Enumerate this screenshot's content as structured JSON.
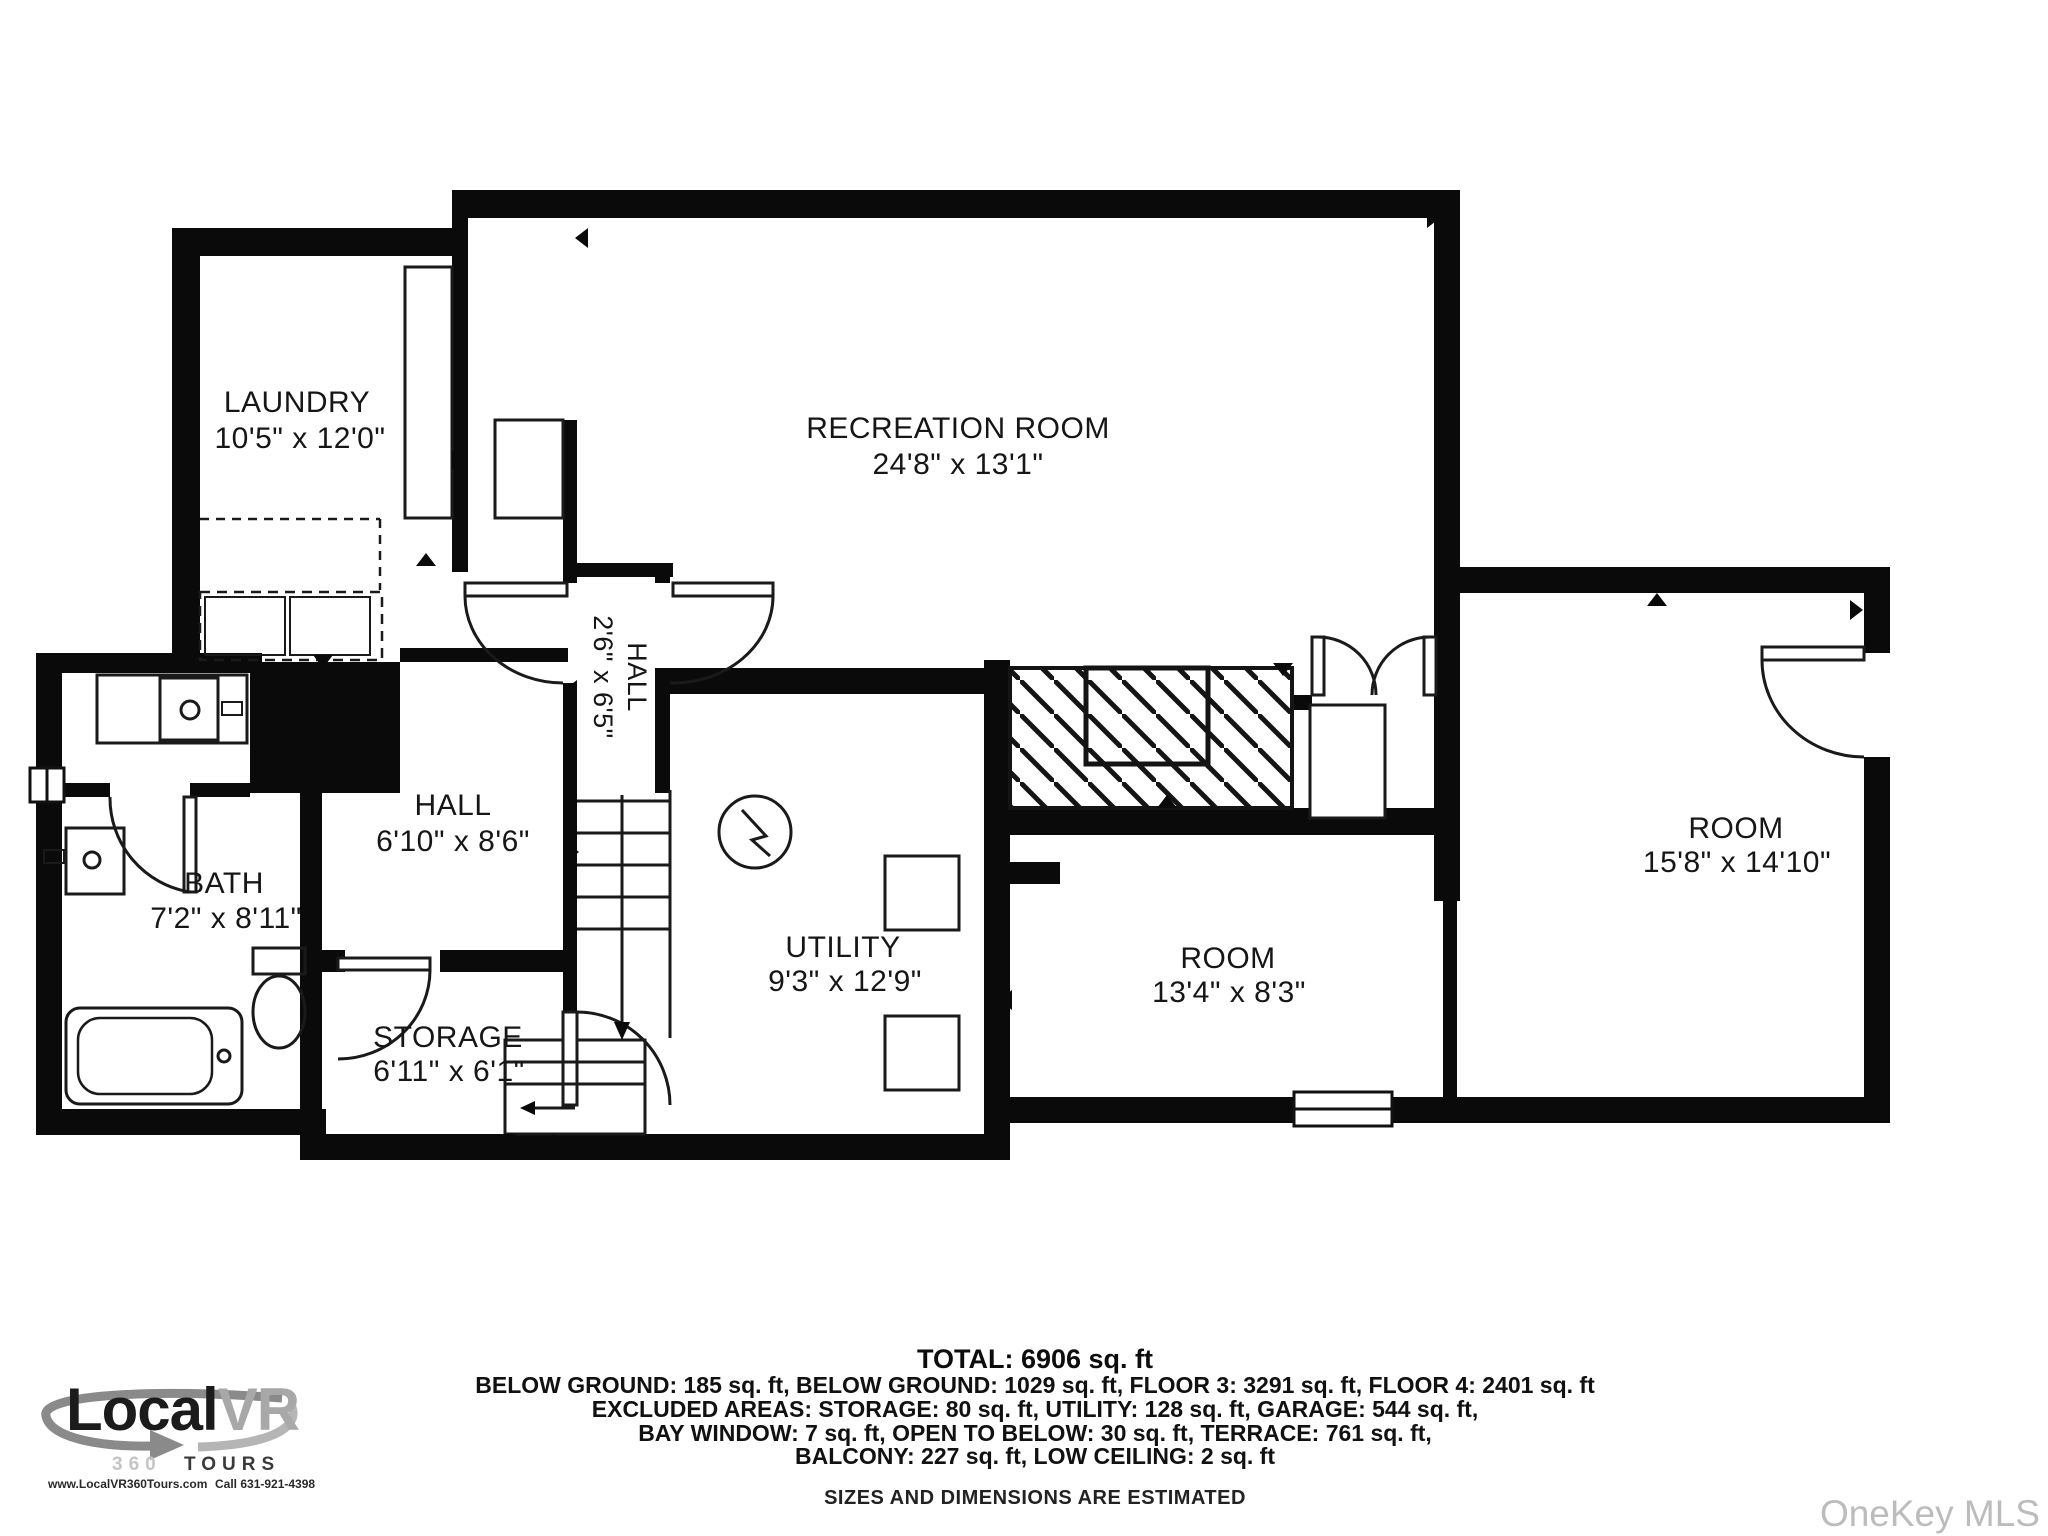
{
  "rooms": [
    {
      "name": "LAUNDRY",
      "dims": "10'5\" x 12'0\""
    },
    {
      "name": "RECREATION ROOM",
      "dims": "24'8\" x 13'1\""
    },
    {
      "name": "HALL",
      "dims": "2'6\" x 6'5\""
    },
    {
      "name": "HALL",
      "dims": "6'10\" x 8'6\""
    },
    {
      "name": "BATH",
      "dims": "7'2\" x 8'11\""
    },
    {
      "name": "STORAGE",
      "dims": "6'11\" x 6'1\""
    },
    {
      "name": "UTILITY",
      "dims": "9'3\" x 12'9\""
    },
    {
      "name": "ROOM",
      "dims": "13'4\" x 8'3\""
    },
    {
      "name": "ROOM",
      "dims": "15'8\" x 14'10\""
    }
  ],
  "footer": {
    "total": "TOTAL: 6906 sq. ft",
    "line1": "BELOW GROUND: 185 sq. ft, BELOW GROUND: 1029 sq. ft, FLOOR 3: 3291 sq. ft, FLOOR 4: 2401 sq. ft",
    "line2": "EXCLUDED AREAS: STORAGE: 80 sq. ft, UTILITY: 128 sq. ft, GARAGE: 544 sq. ft,",
    "line3": "BAY WINDOW: 7 sq. ft, OPEN TO BELOW: 30 sq. ft, TERRACE: 761 sq. ft,",
    "line4": "BALCONY: 227 sq. ft, LOW CEILING: 2 sq. ft",
    "disclaimer": "SIZES AND DIMENSIONS ARE ESTIMATED"
  },
  "branding": {
    "logo_local": "Local",
    "logo_vr": "VR",
    "sub_360": "360",
    "sub_tours": "TOURS",
    "website": "www.LocalVR360Tours.com",
    "phone": "Call 631-921-4398"
  },
  "watermark": "OneKey MLS",
  "colors": {
    "wall": "#0a0a0a",
    "line": "#1a1a1a",
    "logo_gray": "#a8a8a8",
    "watermark_gray": "#bcbcbc"
  }
}
